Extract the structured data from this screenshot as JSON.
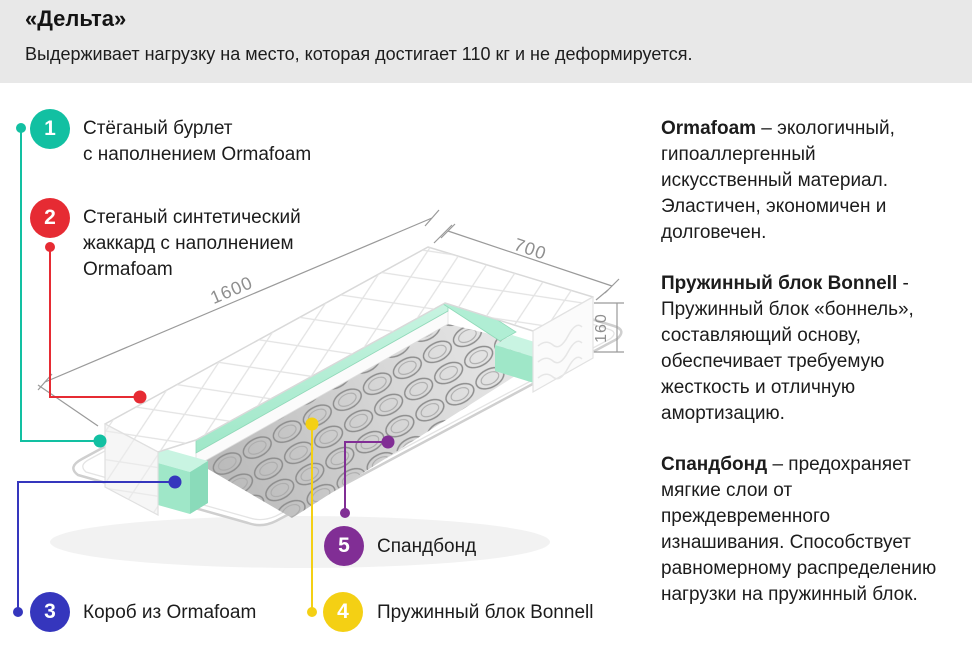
{
  "header": {
    "title": "«Дельта»",
    "subtitle": "Выдерживает нагрузку на место, которая достигает 110 кг и не деформируется."
  },
  "callouts": [
    {
      "number": "1",
      "label": "Стёганый бурлет\nс наполнением Ormafoam",
      "color": "#12c0a2"
    },
    {
      "number": "2",
      "label": "Стеганый синтетический\nжаккард с наполнением\nOrmafoam",
      "color": "#e62b33"
    },
    {
      "number": "3",
      "label": "Короб из Ormafoam",
      "color": "#3536bd"
    },
    {
      "number": "4",
      "label": "Пружинный блок Bonnell",
      "color": "#f4d014"
    },
    {
      "number": "5",
      "label": "Спандбонд",
      "color": "#812e95"
    }
  ],
  "dimensions": {
    "length": "1600",
    "width": "700",
    "height": "160"
  },
  "info": [
    {
      "term": "Ormafoam",
      "text": " – экологичный, гипоаллергенный искусственный материал. Эластичен, экономичен и долговечен."
    },
    {
      "term": "Пружинный блок Bonnell",
      "text": " - Пружинный блок «боннель», составляющий основу, обеспечивает требуемую жесткость и отличную амортизацию."
    },
    {
      "term": "Спандбонд",
      "text": " – предохраняет мягкие слои от преждевременного изнашивания. Способствует равномерному распределению нагрузки на пружинный блок."
    }
  ],
  "colors": {
    "header_bg": "#e8e8e8",
    "foam_green": "#a9ecd1",
    "spring_gray": "#8d8d8d",
    "dimension_gray": "#9a9a9a"
  }
}
